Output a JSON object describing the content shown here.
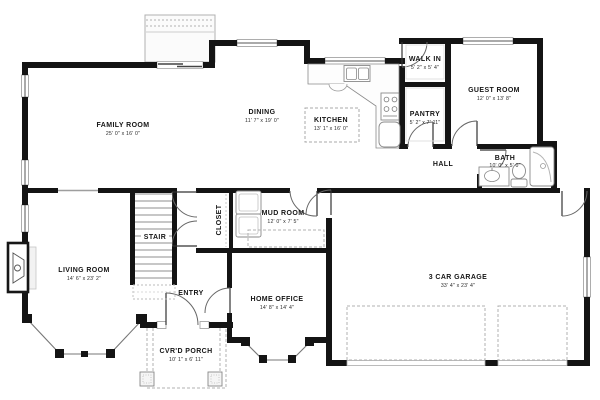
{
  "drawing": {
    "type": "first-floor-plan",
    "colors": {
      "walls": "#141414",
      "window_frame": "#999999",
      "dashed_lines": "#b0b0b0",
      "background": "#ffffff"
    }
  },
  "rooms": {
    "family": {
      "name": "FAMILY ROOM",
      "dims": "25' 0\" x 16' 0\""
    },
    "dining": {
      "name": "DINING",
      "dims": "11' 7\" x 19' 0\""
    },
    "kitchen": {
      "name": "KITCHEN",
      "dims": "13' 1\" x 16' 0\""
    },
    "walk_in": {
      "name": "WALK IN",
      "dims": "5' 2\" x 5' 4\""
    },
    "pantry": {
      "name": "PANTRY",
      "dims": "5' 2\" x 7' 11\""
    },
    "guest": {
      "name": "GUEST ROOM",
      "dims": "12' 0\" x 13' 8\""
    },
    "hall": {
      "name": "HALL"
    },
    "bath": {
      "name": "BATH",
      "dims": "10' 0\" x 5' 0\""
    },
    "mud": {
      "name": "MUD ROOM",
      "dims": "12' 0\" x 7' 5\""
    },
    "closet": {
      "name": "CLOSET"
    },
    "stair": {
      "name": "STAIR"
    },
    "entry": {
      "name": "ENTRY"
    },
    "living": {
      "name": "LIVING ROOM",
      "dims": "14' 6\" x 23' 2\""
    },
    "office": {
      "name": "HOME OFFICE",
      "dims": "14' 8\" x 14' 4\""
    },
    "porch": {
      "name": "CVR'D PORCH",
      "dims": "10' 1\" x 6' 11\""
    },
    "garage": {
      "name": "3 CAR GARAGE",
      "dims": "33' 4\" x 23' 4\""
    }
  }
}
